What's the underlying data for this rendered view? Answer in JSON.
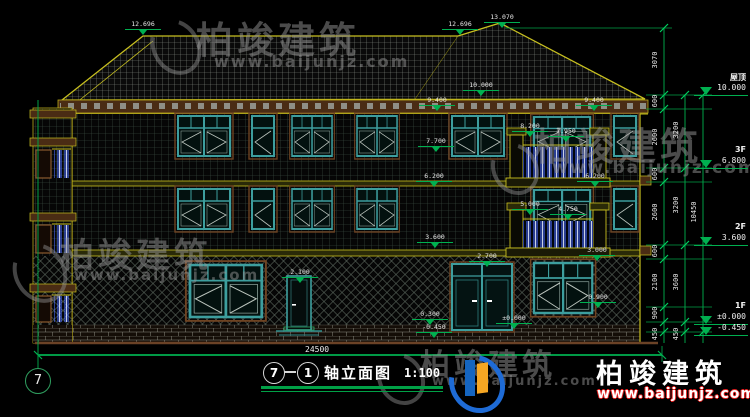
{
  "title_block": {
    "axis_from": "7",
    "axis_to": "1",
    "name": "轴立面图",
    "scale": "1:100"
  },
  "ground_dimension": "24500",
  "axis_bubble": "7",
  "right_markers": [
    {
      "name": "屋顶",
      "elev": "10.000",
      "y": 95
    },
    {
      "name": "3F",
      "elev": "6.800",
      "y": 168
    },
    {
      "name": "2F",
      "elev": "3.600",
      "y": 245
    },
    {
      "name": "1F",
      "elev": "±0.000",
      "y": 324
    },
    {
      "name": "",
      "elev": "-0.450",
      "y": 335
    }
  ],
  "dim_chains": [
    {
      "x": 664,
      "labels": [
        {
          "v": "3070",
          "y": 61
        },
        {
          "v": "600",
          "y": 102
        },
        {
          "v": "2600",
          "y": 138
        },
        {
          "v": "600",
          "y": 175
        },
        {
          "v": "2600",
          "y": 213
        },
        {
          "v": "600",
          "y": 252
        },
        {
          "v": "2100",
          "y": 283
        },
        {
          "v": "900",
          "y": 314
        },
        {
          "v": "450",
          "y": 335
        }
      ]
    },
    {
      "x": 685,
      "labels": [
        {
          "v": "3200",
          "y": 131
        },
        {
          "v": "3200",
          "y": 206
        },
        {
          "v": "3600",
          "y": 283
        },
        {
          "v": "450",
          "y": 335
        }
      ]
    },
    {
      "x": 703,
      "labels": [
        {
          "v": "10450",
          "y": 213
        }
      ]
    }
  ],
  "elevation_marks": [
    {
      "t": "12.696",
      "x": 143,
      "y": 21
    },
    {
      "t": "13.070",
      "x": 502,
      "y": 14
    },
    {
      "t": "12.696",
      "x": 460,
      "y": 21
    },
    {
      "t": "10.000",
      "x": 481,
      "y": 82
    },
    {
      "t": "9.400",
      "x": 437,
      "y": 97
    },
    {
      "t": "9.400",
      "x": 594,
      "y": 97
    },
    {
      "t": "8.200",
      "x": 530,
      "y": 123
    },
    {
      "t": "7.950",
      "x": 566,
      "y": 128
    },
    {
      "t": "7.700",
      "x": 436,
      "y": 138
    },
    {
      "t": "6.200",
      "x": 434,
      "y": 173
    },
    {
      "t": "6.200",
      "x": 595,
      "y": 173
    },
    {
      "t": "5.000",
      "x": 530,
      "y": 201
    },
    {
      "t": "4.750",
      "x": 568,
      "y": 206
    },
    {
      "t": "3.600",
      "x": 435,
      "y": 234
    },
    {
      "t": "3.000",
      "x": 597,
      "y": 247
    },
    {
      "t": "2.700",
      "x": 487,
      "y": 253
    },
    {
      "t": "2.100",
      "x": 300,
      "y": 269
    },
    {
      "t": "0.900",
      "x": 598,
      "y": 294
    },
    {
      "t": "0.300",
      "x": 430,
      "y": 311
    },
    {
      "t": "±0.000",
      "x": 514,
      "y": 315
    },
    {
      "t": "-0.450",
      "x": 434,
      "y": 324
    }
  ],
  "watermark": {
    "brand": "柏竣建筑",
    "url": "www.baijunjz.com"
  },
  "logo": {
    "brand": "柏竣建筑",
    "url": "www.baijunjz.com"
  },
  "colors": {
    "background": "#000000",
    "outline_yellow": "#c8c020",
    "dimension_green": "#00b050",
    "window_teal": "#3d9e9e",
    "baluster_blue": "#4a6cff",
    "fascia_brown": "#6b4226",
    "logo_blue": "#1565c0",
    "logo_orange": "#f5a623",
    "logo_url_red": "#e02020"
  }
}
